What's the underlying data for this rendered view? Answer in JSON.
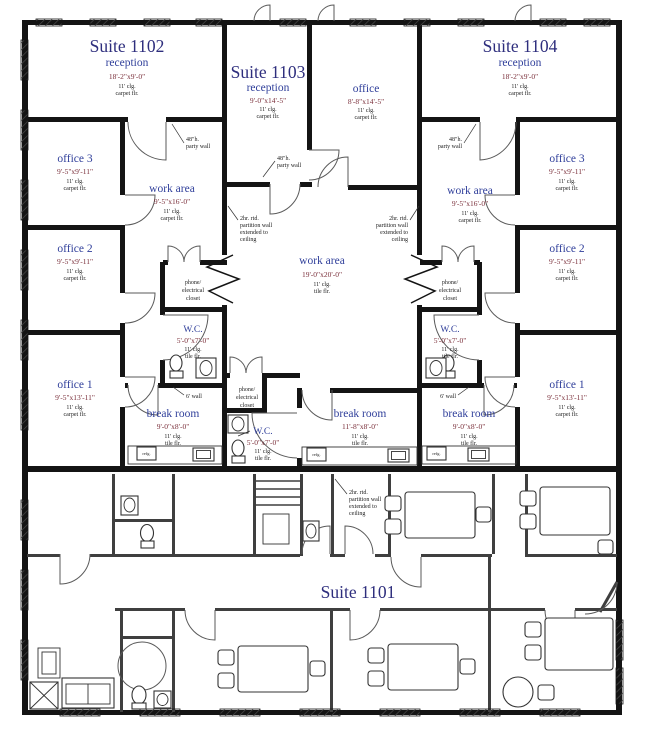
{
  "plan": {
    "suites": {
      "s1102": {
        "title": "Suite 1102"
      },
      "s1103": {
        "title": "Suite 1103"
      },
      "s1104": {
        "title": "Suite 1104"
      },
      "s1101": {
        "title": "Suite 1101"
      }
    },
    "rooms": {
      "r1102_reception": {
        "name": "reception",
        "dims": "18'-2\"x9'-0\"",
        "clg": "11' clg.",
        "floor": "carpet flr."
      },
      "r1102_office3": {
        "name": "office 3",
        "dims": "9'-5\"x9'-11\"",
        "clg": "11' clg.",
        "floor": "carpet flr."
      },
      "r1102_office2": {
        "name": "office 2",
        "dims": "9'-5\"x9'-11\"",
        "clg": "11' clg.",
        "floor": "carpet flr."
      },
      "r1102_office1": {
        "name": "office 1",
        "dims": "9'-5\"x13'-11\"",
        "clg": "11' clg.",
        "floor": "carpet flr."
      },
      "r1102_work": {
        "name": "work area",
        "dims": "9'-5\"x16'-0\"",
        "clg": "11' clg.",
        "floor": "carpet flr."
      },
      "r1102_break": {
        "name": "break room",
        "dims": "9'-0\"x8'-0\"",
        "clg": "11' clg.",
        "floor": "tile flr."
      },
      "r1102_wc": {
        "name": "W.C.",
        "dims": "5'-0\"x7'-0\"",
        "clg": "11' clg.",
        "floor": "tile flr."
      },
      "r1102_closet": {
        "line1": "phone/",
        "line2": "electrical",
        "line3": "closet"
      },
      "r1103_reception": {
        "name": "reception",
        "dims": "9'-0\"x14'-5\"",
        "clg": "11' clg.",
        "floor": "carpet flr."
      },
      "r1103_office": {
        "name": "office",
        "dims": "8'-8\"x14'-5\"",
        "clg": "11' clg.",
        "floor": "carpet flr."
      },
      "r1103_work": {
        "name": "work area",
        "dims": "19'-0\"x20'-0\"",
        "clg": "11' clg.",
        "floor": "tile flr."
      },
      "r1103_break": {
        "name": "break room",
        "dims": "11'-8\"x8'-0\"",
        "clg": "11' clg.",
        "floor": "tile flr."
      },
      "r1103_wc": {
        "name": "W.C.",
        "dims": "5'-0\"x7'-0\"",
        "clg": "11' clg.",
        "floor": "tile flr."
      },
      "r1103_closet": {
        "line1": "phone/",
        "line2": "electrical",
        "line3": "closet"
      },
      "r1104_reception": {
        "name": "reception",
        "dims": "18'-2\"x9'-0\"",
        "clg": "11' clg.",
        "floor": "carpet flr."
      },
      "r1104_office3": {
        "name": "office 3",
        "dims": "9'-5\"x9'-11\"",
        "clg": "11' clg.",
        "floor": "carpet flr."
      },
      "r1104_office2": {
        "name": "office 2",
        "dims": "9'-5\"x9'-11\"",
        "clg": "11' clg.",
        "floor": "carpet flr."
      },
      "r1104_office1": {
        "name": "office 1",
        "dims": "9'-5\"x13'-11\"",
        "clg": "11' clg.",
        "floor": "carpet flr."
      },
      "r1104_work": {
        "name": "work area",
        "dims": "9'-5\"x16'-0\"",
        "clg": "11' clg.",
        "floor": "carpet flr."
      },
      "r1104_break": {
        "name": "break room",
        "dims": "9'-0\"x8'-0\"",
        "clg": "11' clg.",
        "floor": "tile flr."
      },
      "r1104_wc": {
        "name": "W.C.",
        "dims": "5'-0\"x7'-0\"",
        "clg": "11' clg.",
        "floor": "tile flr."
      },
      "r1104_closet": {
        "line1": "phone/",
        "line2": "electrical",
        "line3": "closet"
      }
    },
    "annotations": {
      "party_wall": {
        "line1": "48\"h.",
        "line2": "party wall"
      },
      "partition_wall": {
        "line1": "2hr. rtd.",
        "line2": "partition wall",
        "line3": "extended to",
        "line4": "ceiling"
      },
      "six_wall": {
        "label": "6' wall"
      },
      "fridge": {
        "label": "refg."
      }
    },
    "colors": {
      "suite_title": "#2e2e7d",
      "room_name": "#31409b",
      "dimensions": "#7a2f3a",
      "small_text": "#1c1c1c",
      "wall": "#141414"
    }
  }
}
